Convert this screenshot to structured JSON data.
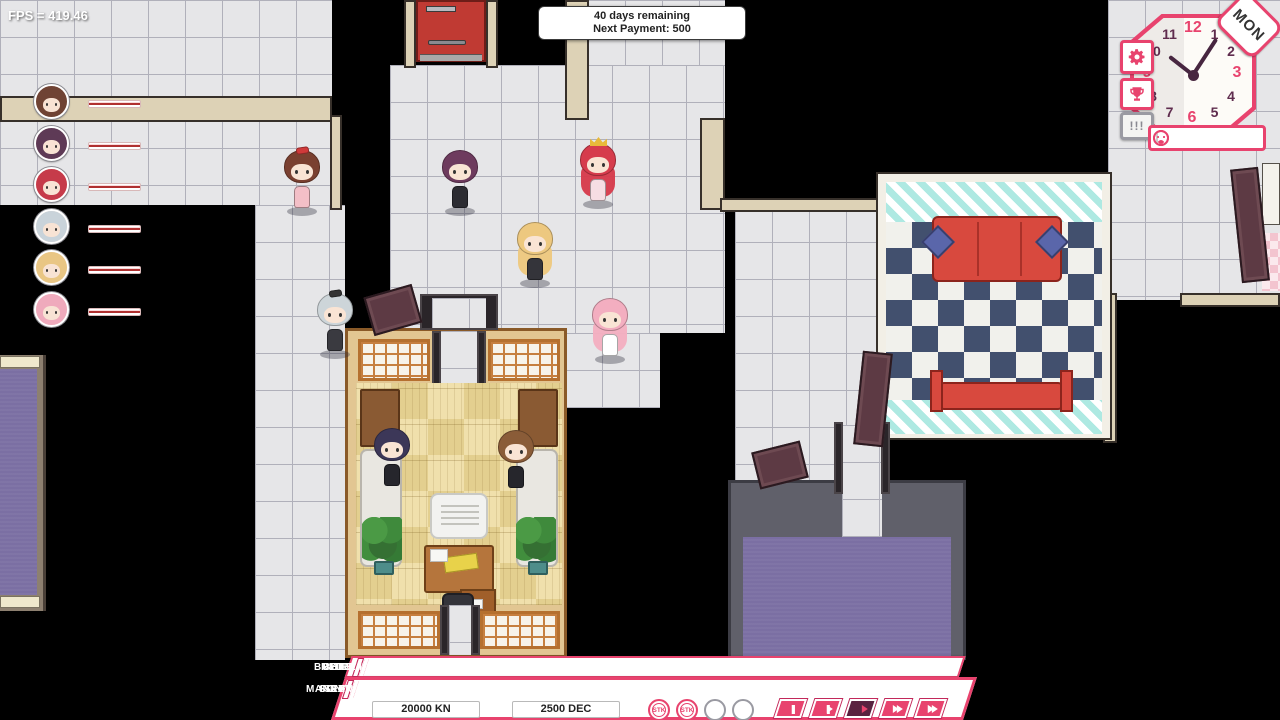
{
  "theme": {
    "accent": "#e8436e",
    "accent_dark": "#c2285a",
    "play_active_bg": "#5a2240",
    "bar_color": "#b03030"
  },
  "hud": {
    "fps_label": "FPS = 419.46",
    "payment_box": {
      "line1": "40 days remaining",
      "line2": "Next Payment: 500"
    },
    "clock": {
      "day_label": "MON",
      "numbers": [
        "12",
        "1",
        "2",
        "3",
        "4",
        "5",
        "6",
        "7",
        "8",
        "9",
        "10",
        "11"
      ],
      "hour_hand_angle": -52,
      "minute_hand_angle": 33,
      "buttons": [
        {
          "id": "settings",
          "icon": "gear-icon"
        },
        {
          "id": "achievements",
          "icon": "trophy-icon"
        },
        {
          "id": "alerts",
          "label": "!!!"
        }
      ],
      "mood_meter": {
        "fill_from_percent": 45,
        "fill_to_percent": 78
      }
    }
  },
  "roster": {
    "portraits": [
      {
        "hair": "#6f4334"
      },
      {
        "hair": "#5e3a56"
      },
      {
        "hair": "#c63b4a"
      },
      {
        "hair": "#c9d3da"
      },
      {
        "hair": "#e9c684"
      },
      {
        "hair": "#efaabc"
      }
    ]
  },
  "world": {
    "characters": [
      {
        "id": "brunette-idol",
        "hair": "#7a4030",
        "dress": "#f3bfc7",
        "accessory": "red-bow",
        "accessory_color": "#d03a3a",
        "x": 282,
        "y": 150,
        "long": false
      },
      {
        "id": "plum-idol",
        "hair": "#6e3b5e",
        "dress": "#2c2c32",
        "x": 440,
        "y": 150,
        "long": false
      },
      {
        "id": "redhead-idol",
        "hair": "#d63c4c",
        "dress": "#f6dde3",
        "accessory": "gold-crown",
        "x": 578,
        "y": 143,
        "long": true
      },
      {
        "id": "blonde-idol",
        "hair": "#edc87f",
        "dress": "#34343a",
        "x": 515,
        "y": 222,
        "long": true
      },
      {
        "id": "pink-idol",
        "hair": "#f3aec0",
        "dress": "#ffffff",
        "x": 590,
        "y": 298,
        "long": true
      },
      {
        "id": "silver-idol",
        "hair": "#cdd5d9",
        "dress": "#3a3a40",
        "accessory": "black-bow",
        "accessory_color": "#333333",
        "x": 315,
        "y": 293,
        "long": false,
        "behind": true
      }
    ],
    "seated_characters": [
      {
        "id": "seated-left",
        "hair": "#3c3758",
        "dress": "#26262c",
        "x": 372,
        "y": 428
      },
      {
        "id": "seated-right",
        "hair": "#8a5c38",
        "dress": "#26262c",
        "x": 496,
        "y": 430
      }
    ]
  },
  "menu": {
    "rows": [
      {
        "buttons": [
          "BUILD ROOM",
          "BUY FURNITURE",
          "REDECORATE",
          "HIRE IDOL"
        ]
      },
      {
        "buttons": [
          "MANAGE IDOLS",
          "SONG LIST",
          "SET LIVE",
          "FINANCES"
        ]
      }
    ],
    "money_primary": "20000 KN",
    "money_secondary": "2500 DEC",
    "stk_slots": [
      "STK",
      "STK",
      "",
      ""
    ],
    "playback": [
      {
        "id": "pause"
      },
      {
        "id": "step"
      },
      {
        "id": "play",
        "active": true
      },
      {
        "id": "fast-forward"
      },
      {
        "id": "fastest"
      }
    ]
  }
}
